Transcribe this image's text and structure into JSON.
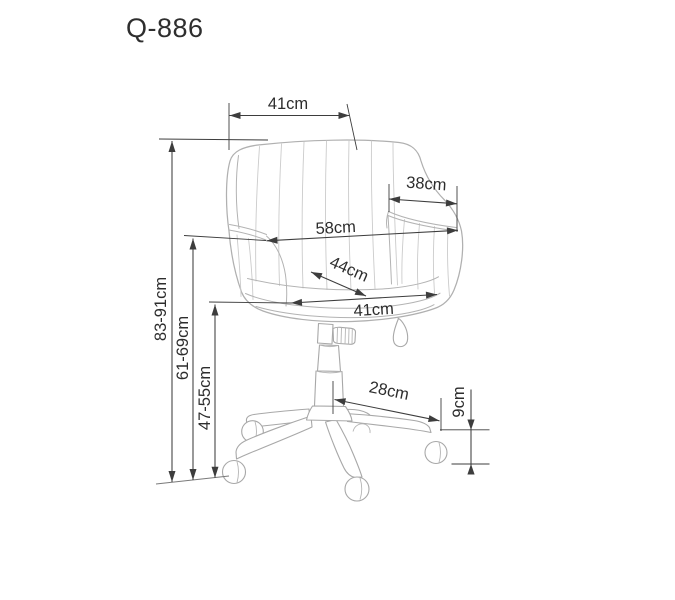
{
  "title": "Q-886",
  "colors": {
    "background": "#ffffff",
    "dimension_line": "#3d3d3d",
    "drawing_line": "#b0b0b0",
    "text": "#2d2d2d"
  },
  "dimensions": {
    "backrest_top_width": "41cm",
    "armrest_depth": "38cm",
    "overall_width": "58cm",
    "seat_depth": "44cm",
    "seat_width": "41cm",
    "total_height": "83-91cm",
    "armrest_height": "61-69cm",
    "seat_height": "47-55cm",
    "base_leg_length": "28cm",
    "caster_height": "9cm"
  }
}
